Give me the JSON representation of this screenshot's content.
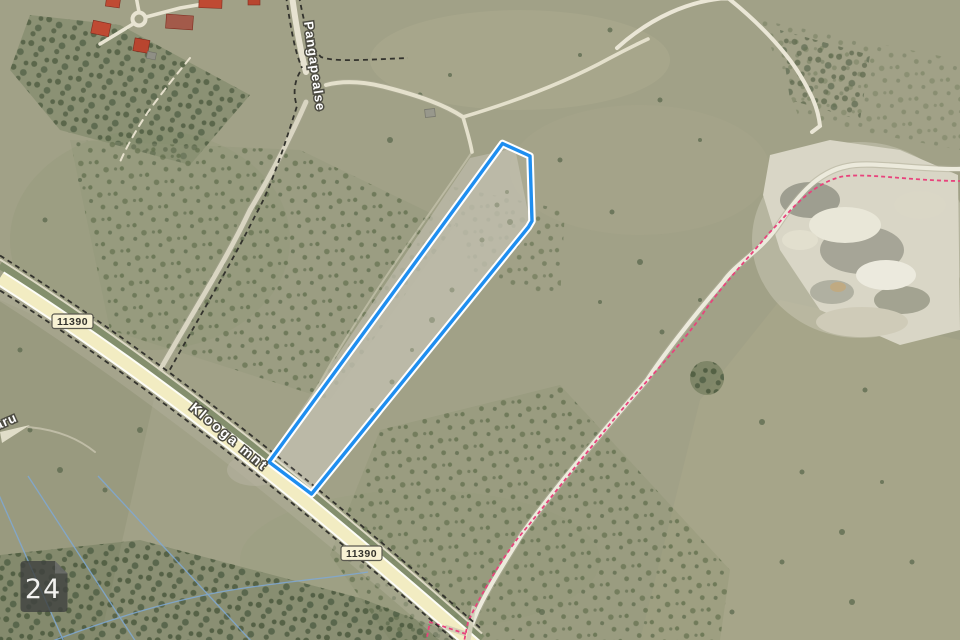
{
  "map": {
    "labels": {
      "street_pangapealse": "Pangapealse",
      "street_klooga": "Klooga mnt",
      "place_partial": "aru",
      "road_number": "11390",
      "map_sheet": "24"
    },
    "colors": {
      "parcel_outline": "#1e8ef0",
      "parcel_casing": "#ffffff",
      "trail_dashes": "#e8437c",
      "road_fill": "#f2ecc2",
      "boundary_dashes": "#33332d",
      "water_lines": "#7fa9d6",
      "badge_background": "#f8f2d4",
      "sheet_badge_background": "rgba(64,66,64,0.82)"
    }
  }
}
